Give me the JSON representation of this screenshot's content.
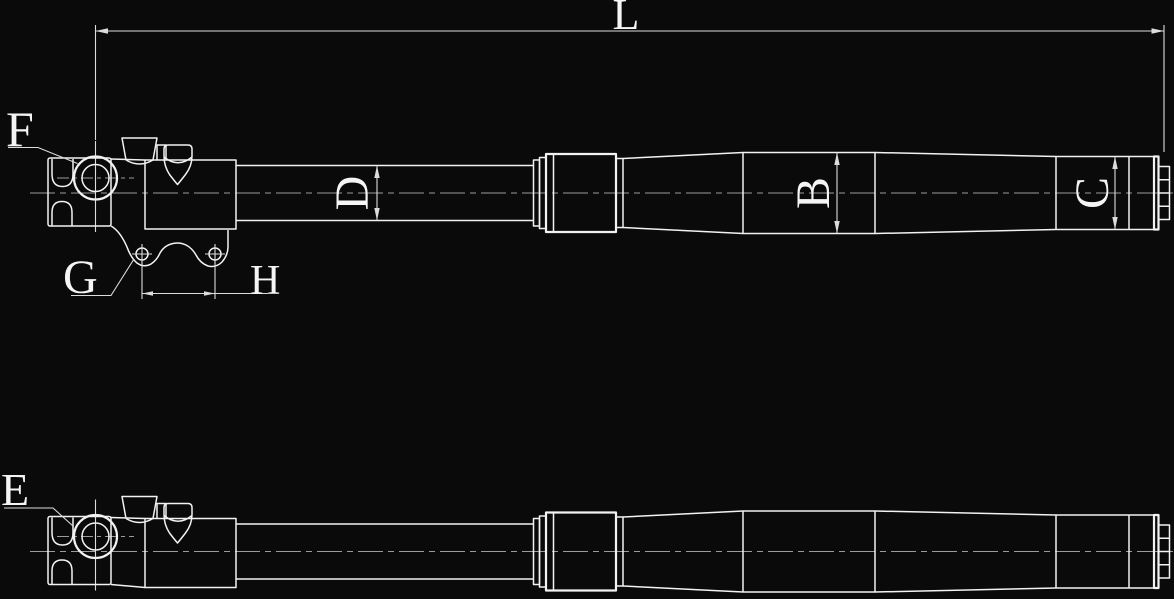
{
  "drawing": {
    "labels": {
      "overall_length": "L",
      "eye_detail_top": "F",
      "bracket_detail": "G",
      "hole_spacing": "H",
      "rod_diameter": "D",
      "body_diameter": "B",
      "end_diameter": "C",
      "eye_detail_bottom": "E"
    },
    "colors": {
      "background": "#0a0a0a",
      "line": "#f2f2f2",
      "centerline": "#9c9c9c",
      "dimension": "#dcdcdc",
      "text": "#f5f5f5"
    }
  }
}
